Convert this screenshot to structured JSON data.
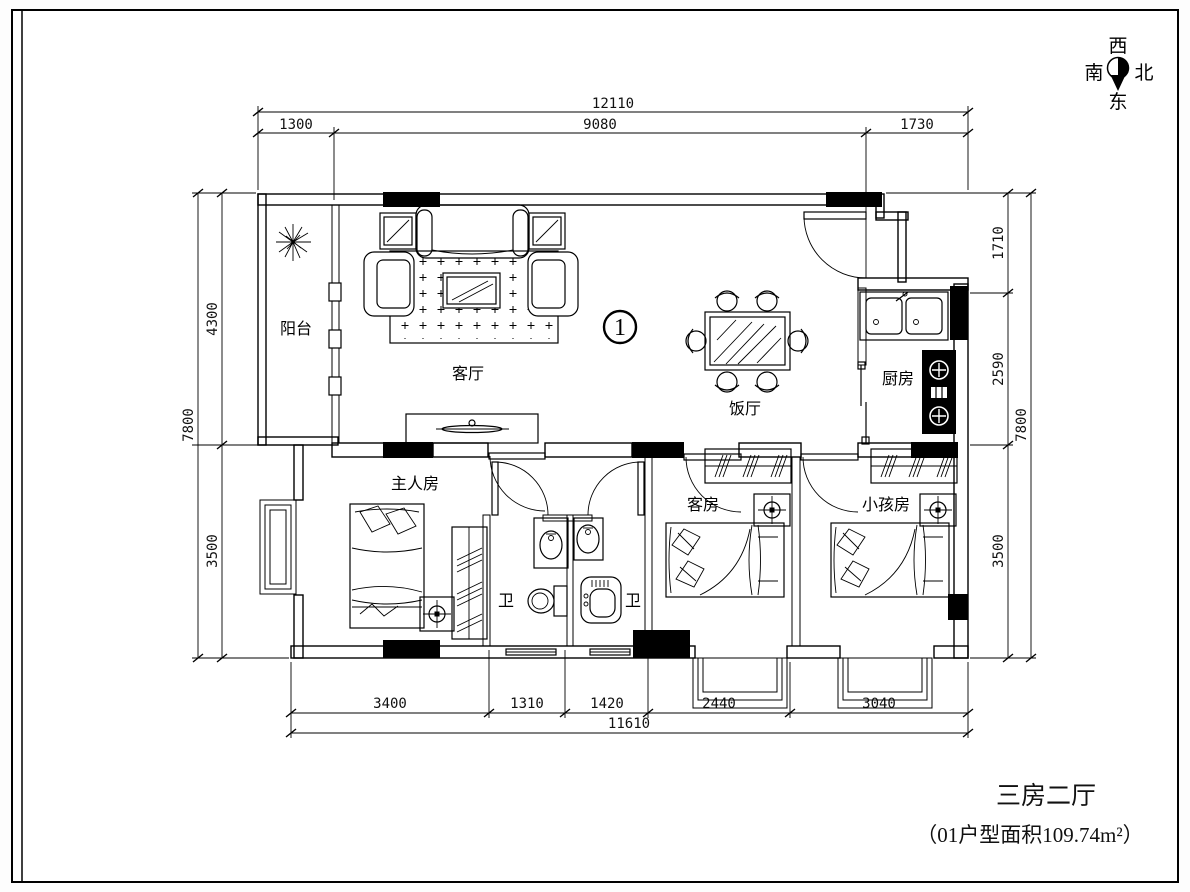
{
  "title": {
    "line1": "三房二厅",
    "line2": "（01户型面积109.74m²）"
  },
  "unit": {
    "number": "1"
  },
  "compass": {
    "top": "西",
    "left": "南",
    "right": "北",
    "bottom": "东"
  },
  "rooms": {
    "balcony": "阳台",
    "living": "客厅",
    "dining": "饭厅",
    "kitchen": "厨房",
    "master": "主人房",
    "bath1": "卫",
    "bath2": "卫",
    "guest": "客房",
    "kids": "小孩房"
  },
  "dims": {
    "top": {
      "overall": "12110",
      "segments": [
        "1300",
        "9080",
        "1730"
      ]
    },
    "bottom": {
      "overall": "11610",
      "segments": [
        "3400",
        "1310",
        "1420",
        "2440",
        "3040"
      ]
    },
    "left": {
      "overall": "7800",
      "segments": [
        "4300",
        "3500"
      ]
    },
    "right": {
      "overall": "7800",
      "segments": [
        "1710",
        "2590",
        "3500"
      ]
    }
  },
  "colors": {
    "line": "#000000",
    "paper": "#ffffff"
  }
}
